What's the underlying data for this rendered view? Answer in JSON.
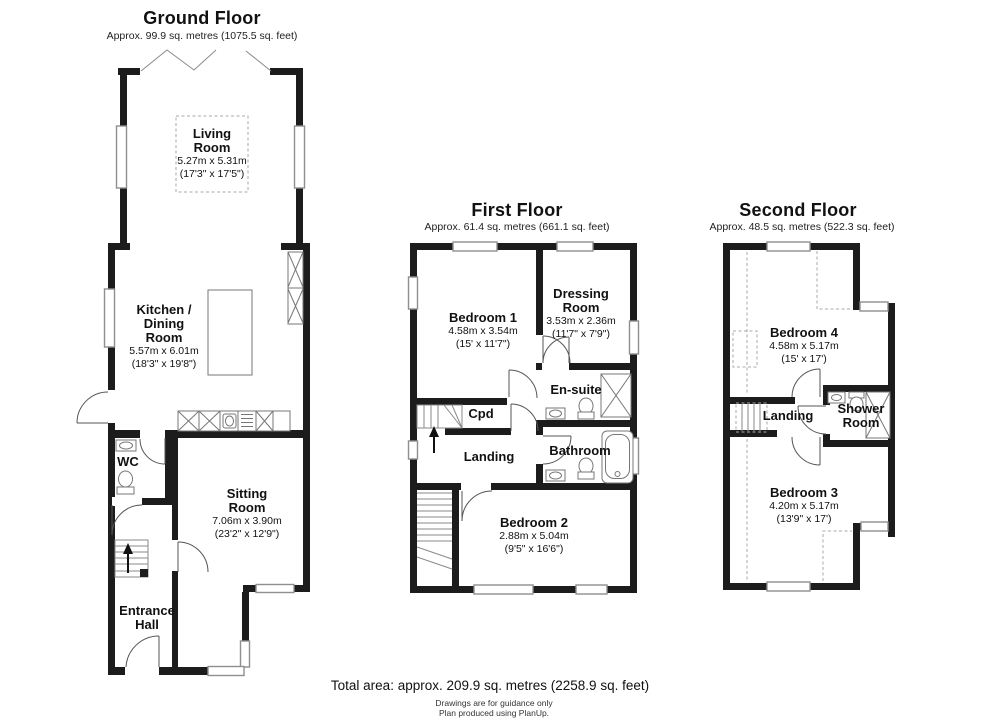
{
  "colors": {
    "wall": "#1c1c1c",
    "window_stroke": "#8f8f8f",
    "text": "#111111"
  },
  "floors": [
    {
      "title": "Ground Floor",
      "subtitle": "Approx. 99.9 sq. metres (1075.5 sq. feet)",
      "rooms": [
        {
          "key": "living_room",
          "name_lines": [
            "Living",
            "Room"
          ],
          "dims_m": "5.27m x 5.31m",
          "dims_ft": "(17'3\" x 17'5\")"
        },
        {
          "key": "kitchen_dining",
          "name_lines": [
            "Kitchen /",
            "Dining",
            "Room"
          ],
          "dims_m": "5.57m x 6.01m",
          "dims_ft": "(18'3\" x 19'8\")"
        },
        {
          "key": "wc",
          "name_lines": [
            "WC"
          ]
        },
        {
          "key": "sitting_room",
          "name_lines": [
            "Sitting",
            "Room"
          ],
          "dims_m": "7.06m x 3.90m",
          "dims_ft": "(23'2\" x 12'9\")"
        },
        {
          "key": "entrance_hall",
          "name_lines": [
            "Entrance",
            "Hall"
          ]
        }
      ]
    },
    {
      "title": "First Floor",
      "subtitle": "Approx. 61.4 sq. metres (661.1 sq. feet)",
      "rooms": [
        {
          "key": "bedroom1",
          "name_lines": [
            "Bedroom 1"
          ],
          "dims_m": "4.58m x 3.54m",
          "dims_ft": "(15' x 11'7\")"
        },
        {
          "key": "dressing_room",
          "name_lines": [
            "Dressing",
            "Room"
          ],
          "dims_m": "3.53m x 2.36m",
          "dims_ft": "(11'7\" x 7'9\")"
        },
        {
          "key": "ensuite",
          "name_lines": [
            "En-suite"
          ]
        },
        {
          "key": "cpd",
          "name_lines": [
            "Cpd"
          ]
        },
        {
          "key": "landing",
          "name_lines": [
            "Landing"
          ]
        },
        {
          "key": "bathroom",
          "name_lines": [
            "Bathroom"
          ]
        },
        {
          "key": "bedroom2",
          "name_lines": [
            "Bedroom 2"
          ],
          "dims_m": "2.88m x 5.04m",
          "dims_ft": "(9'5\" x 16'6\")"
        }
      ]
    },
    {
      "title": "Second Floor",
      "subtitle": "Approx. 48.5 sq. metres (522.3 sq. feet)",
      "rooms": [
        {
          "key": "bedroom4",
          "name_lines": [
            "Bedroom 4"
          ],
          "dims_m": "4.58m x 5.17m",
          "dims_ft": "(15' x 17')"
        },
        {
          "key": "landing2",
          "name_lines": [
            "Landing"
          ]
        },
        {
          "key": "shower_room",
          "name_lines": [
            "Shower",
            "Room"
          ]
        },
        {
          "key": "bedroom3",
          "name_lines": [
            "Bedroom 3"
          ],
          "dims_m": "4.20m x 5.17m",
          "dims_ft": "(13'9\" x 17')"
        }
      ]
    }
  ],
  "footer": {
    "total": "Total area: approx. 209.9 sq. metres (2258.9 sq. feet)",
    "note1": "Drawings are for guidance only",
    "note2": "Plan produced using PlanUp."
  }
}
